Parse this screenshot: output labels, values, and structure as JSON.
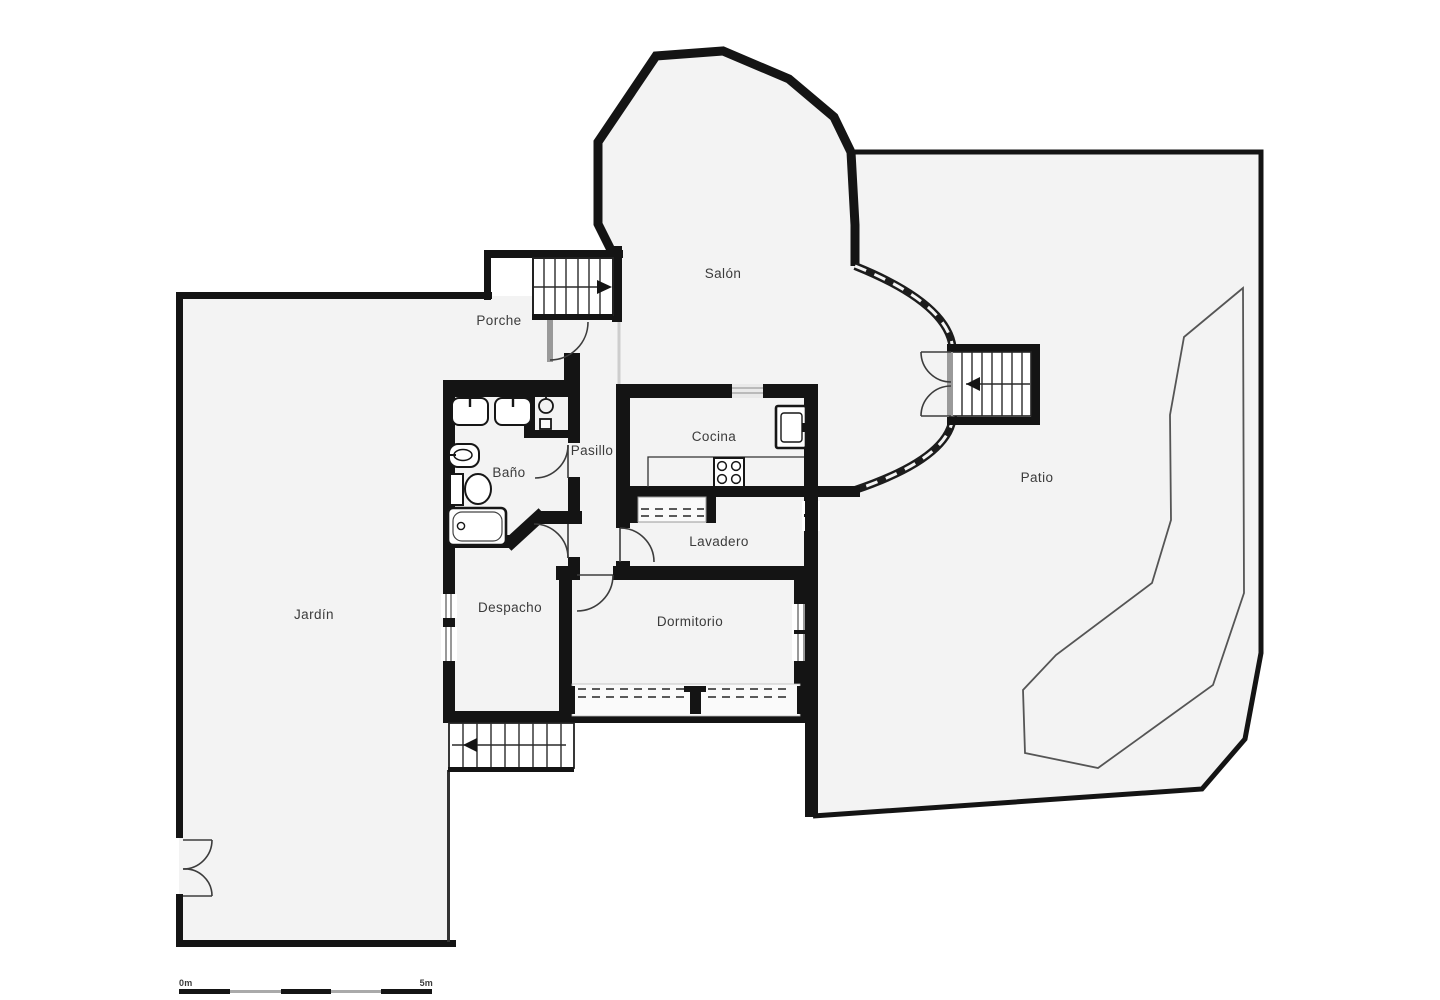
{
  "plan": {
    "type": "floorplan",
    "rooms": [
      {
        "id": "salon",
        "label": "Salón"
      },
      {
        "id": "porche",
        "label": "Porche"
      },
      {
        "id": "cocina",
        "label": "Cocina"
      },
      {
        "id": "pasillo",
        "label": "Pasillo"
      },
      {
        "id": "bano",
        "label": "Baño"
      },
      {
        "id": "lavadero",
        "label": "Lavadero"
      },
      {
        "id": "patio",
        "label": "Patio"
      },
      {
        "id": "despacho",
        "label": "Despacho"
      },
      {
        "id": "dormitorio",
        "label": "Dormitorio"
      },
      {
        "id": "jardin",
        "label": "Jardín"
      }
    ],
    "scale_bar": {
      "start_label": "0m",
      "end_label": "5m"
    },
    "colors": {
      "wall": "#141414",
      "floor": "#f3f3f3",
      "background": "#ffffff",
      "thin_line": "#4d4d4d",
      "text": "#3b3b3b"
    }
  }
}
